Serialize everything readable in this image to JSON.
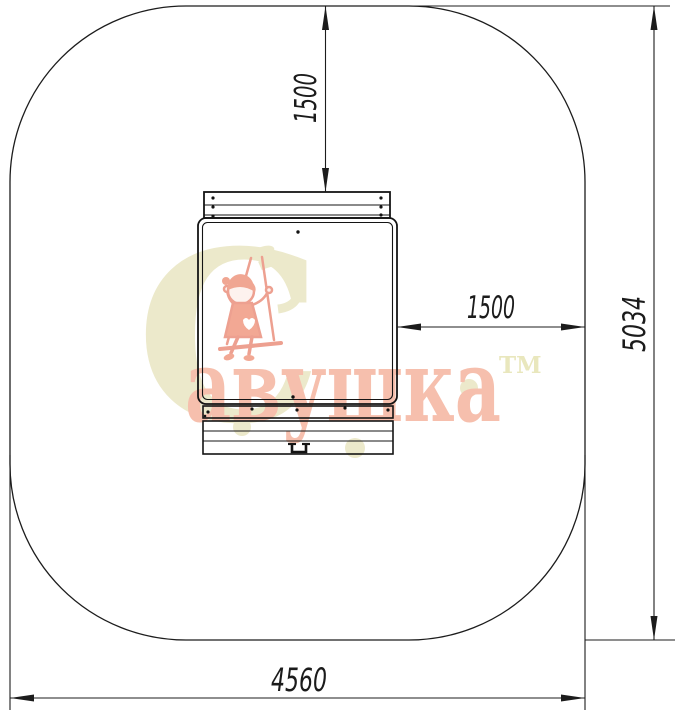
{
  "drawing": {
    "title": "playground-swing-plan-view-with-safety-zone",
    "dimensions": {
      "clearance_top": "1500",
      "clearance_right": "1500",
      "zone_depth": "5034",
      "zone_width": "4560"
    }
  },
  "watermark": {
    "brand_initial": "С",
    "brand_rest": "авушка",
    "trademark": "ТМ"
  },
  "colors": {
    "line": "#1c1c1c",
    "brand_salmon": "#f6bfad",
    "brand_salmon_stroke": "#eda090",
    "brand_khaki": "#ece9cb"
  }
}
